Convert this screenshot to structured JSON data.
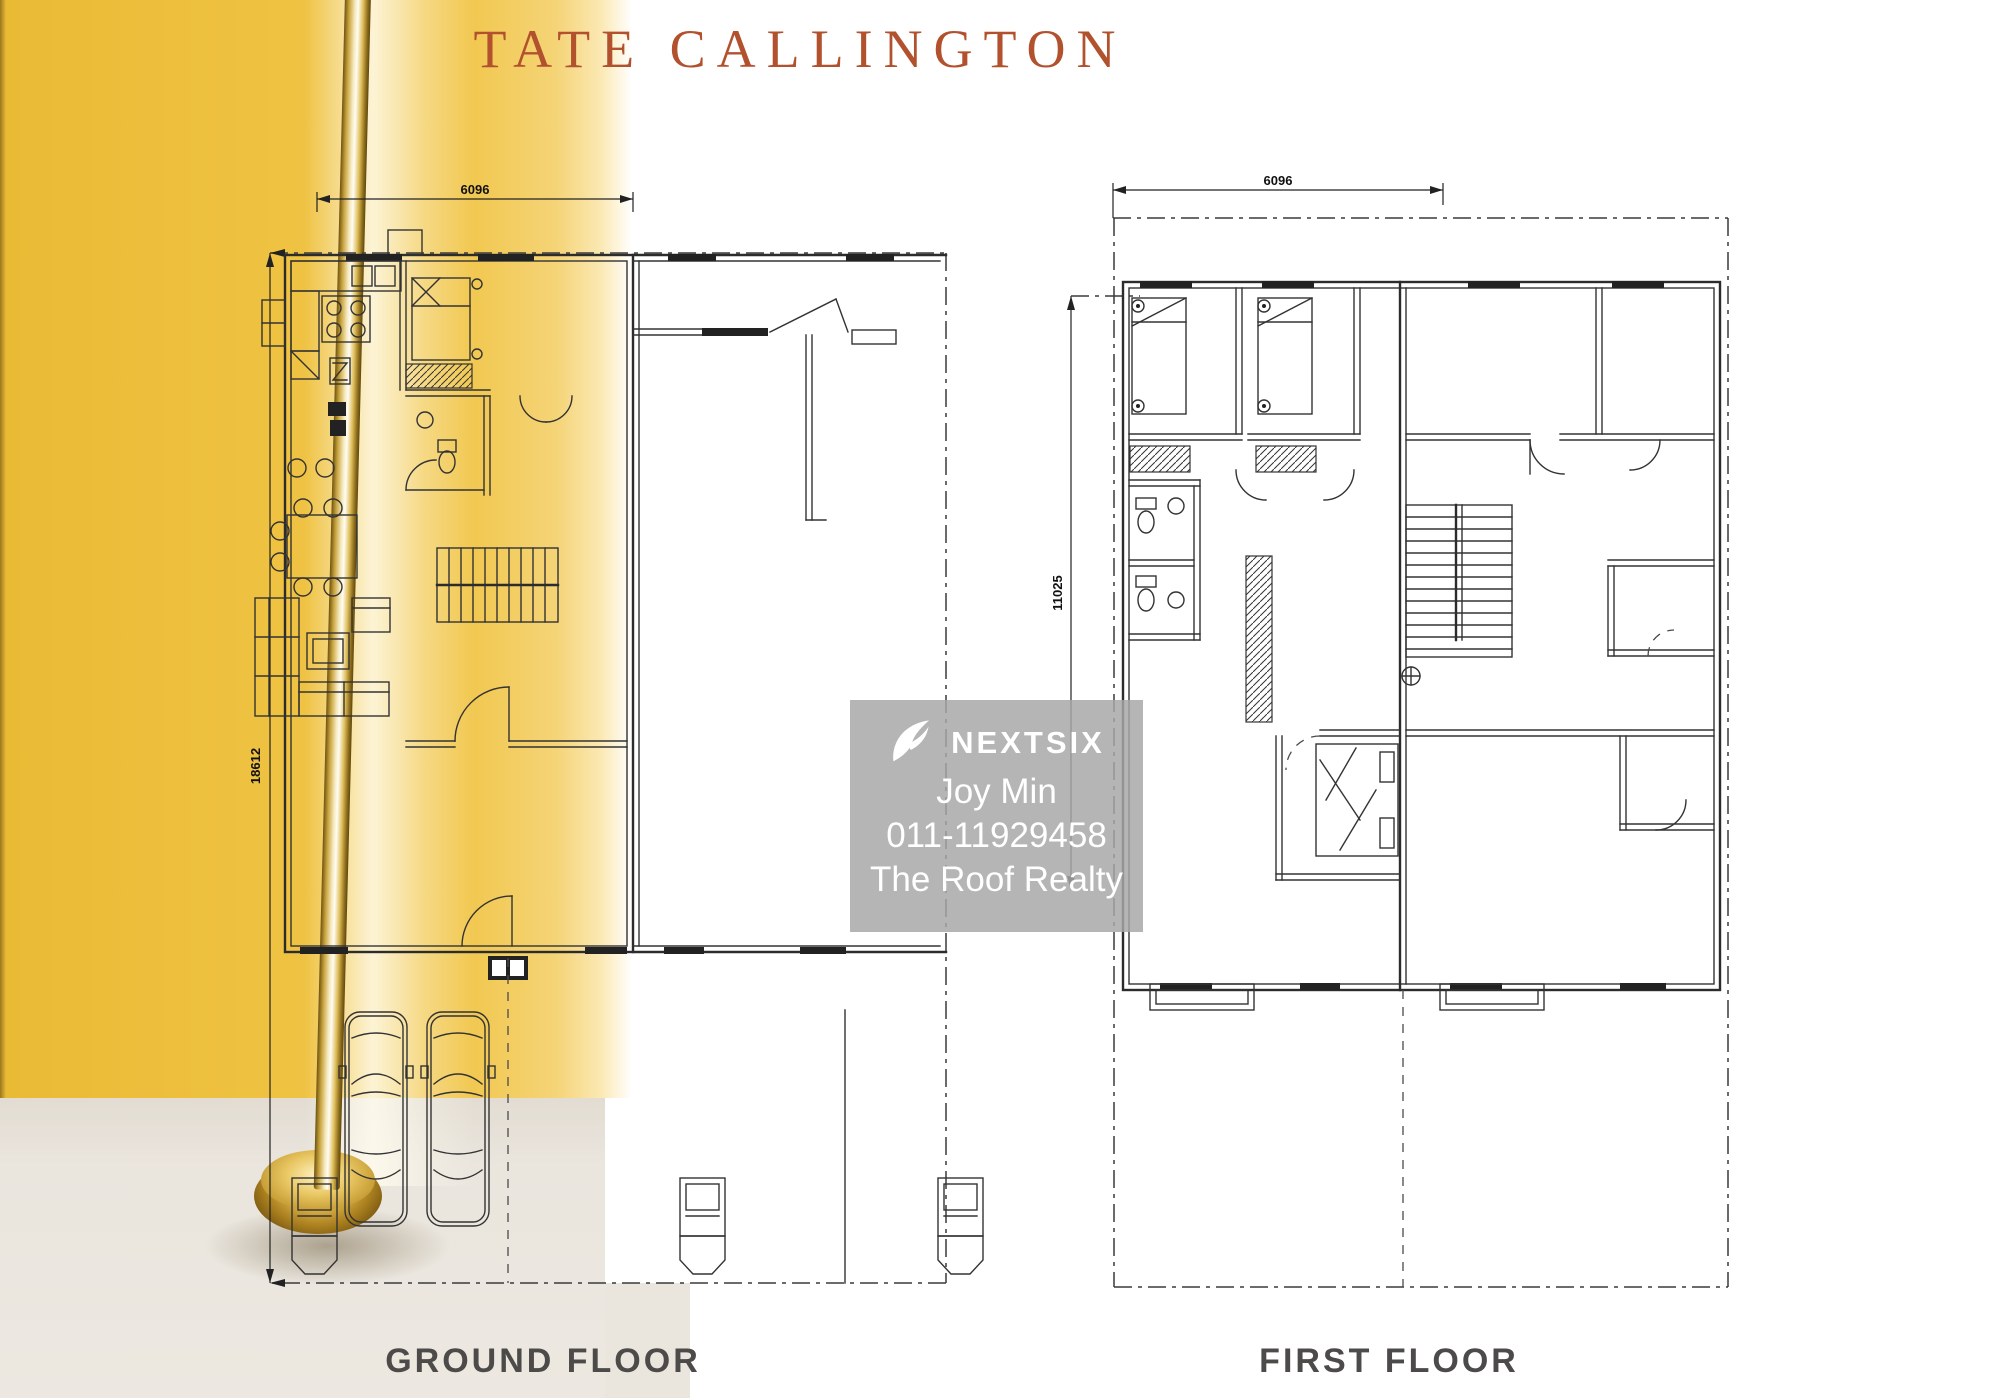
{
  "title": "TATE CALLINGTON",
  "plans": {
    "ground": {
      "label": "GROUND FLOOR",
      "width_mm": "6096",
      "depth_mm": "18612"
    },
    "first": {
      "label": "FIRST FLOOR",
      "width_mm": "6096",
      "depth_mm": "11025"
    }
  },
  "watermark": {
    "brand": "NEXTSIX",
    "agent": "Joy Min",
    "phone": "011-11929458",
    "agency": "The Roof Realty"
  },
  "colors": {
    "accent_yellow": "#EFC23E",
    "title_rust": "#B2512D",
    "floor_beige": "#EAE5DD",
    "label_gray": "#4C4B49",
    "plan_line": "#333333",
    "watermark_bg": "rgba(167,167,167,0.84)",
    "gold_dark": "#6F5310",
    "gold_light": "#FFF3C4"
  }
}
